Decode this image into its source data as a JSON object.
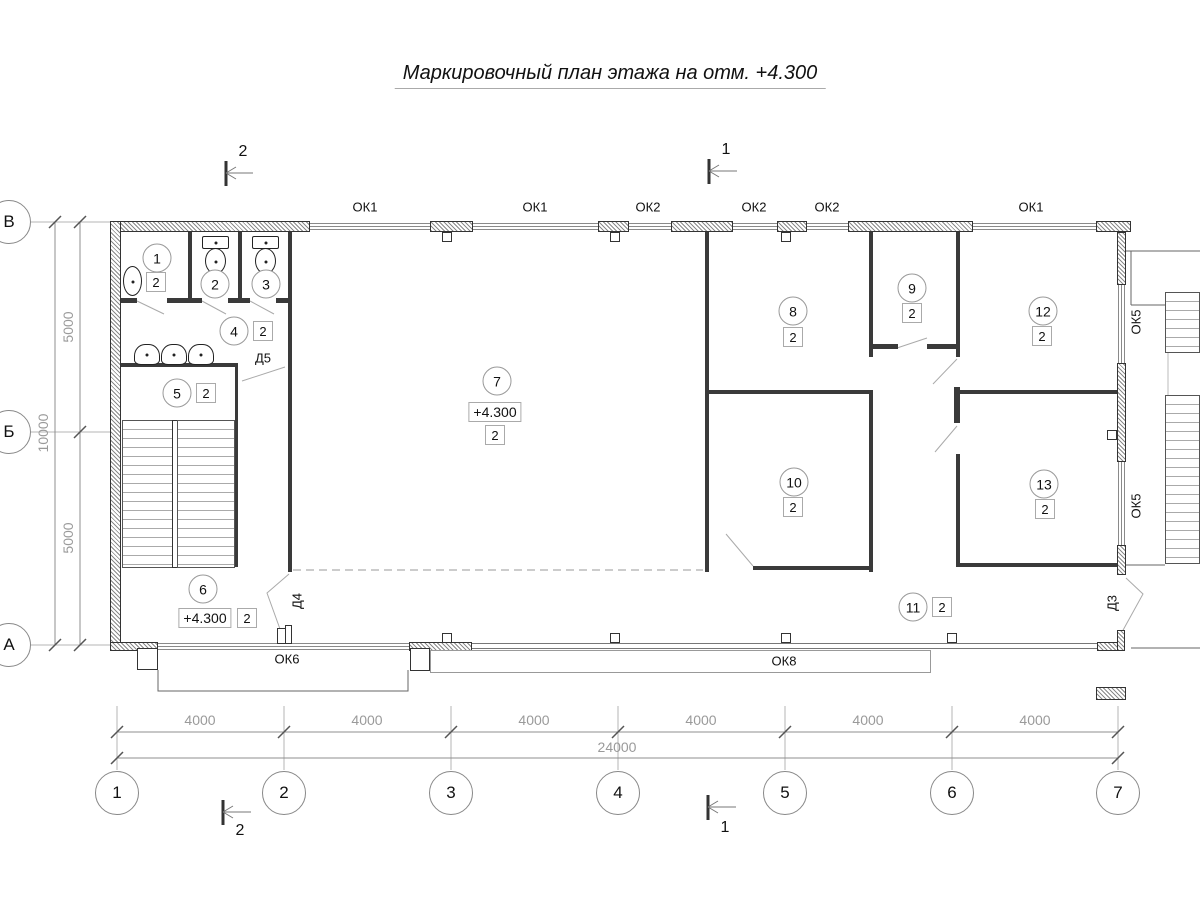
{
  "title": "Маркировочный план этажа на отм. +4.300",
  "section_marks": {
    "top_left": "2",
    "top_right": "1",
    "bottom_left": "2",
    "bottom_right": "1"
  },
  "axes": {
    "vertical": [
      "В",
      "Б",
      "А"
    ],
    "horizontal": [
      "1",
      "2",
      "3",
      "4",
      "5",
      "6",
      "7"
    ]
  },
  "dims": {
    "bottom": [
      "4000",
      "4000",
      "4000",
      "4000",
      "4000",
      "4000"
    ],
    "bottom_total": "24000",
    "left": [
      "5000",
      "5000"
    ],
    "left_total": "10000"
  },
  "windows": {
    "top": [
      "ОК1",
      "ОК1",
      "ОК2",
      "ОК2",
      "ОК2",
      "ОК1"
    ],
    "right": [
      "ОК5",
      "ОК5"
    ],
    "bottom": [
      "ОК6",
      "ОК8"
    ]
  },
  "doors": {
    "d5": "Д5",
    "d4": "Д4",
    "d3": "Д3"
  },
  "elevations": [
    "+4.300",
    "+4.300"
  ],
  "rooms": [
    {
      "number": "1",
      "finish": "2"
    },
    {
      "number": "2",
      "finish": "2"
    },
    {
      "number": "3",
      "finish": "2"
    },
    {
      "number": "4",
      "finish": "2"
    },
    {
      "number": "5",
      "finish": "2"
    },
    {
      "number": "6",
      "finish": "2"
    },
    {
      "number": "7",
      "finish": "2"
    },
    {
      "number": "8",
      "finish": "2"
    },
    {
      "number": "9",
      "finish": "2"
    },
    {
      "number": "10",
      "finish": "2"
    },
    {
      "number": "11",
      "finish": "2"
    },
    {
      "number": "12",
      "finish": "2"
    },
    {
      "number": "13",
      "finish": "2"
    }
  ]
}
